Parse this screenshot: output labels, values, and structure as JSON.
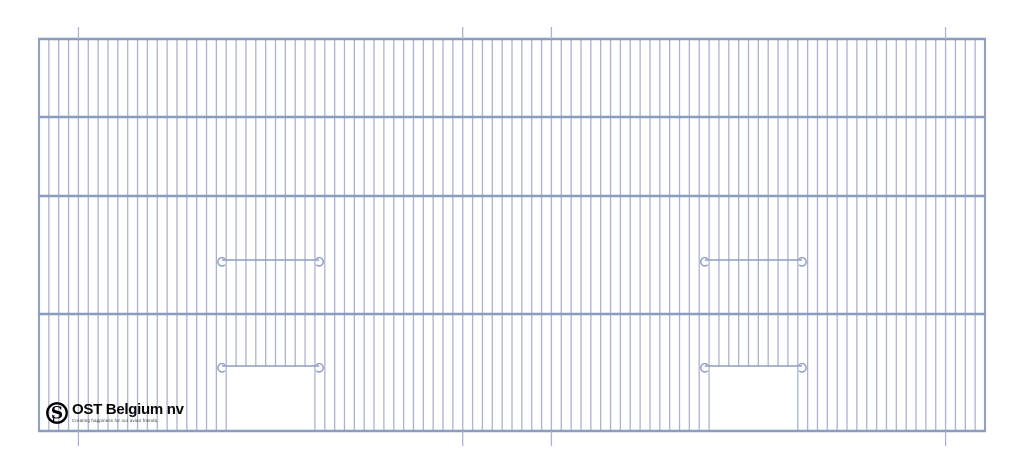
{
  "logo": {
    "name": "OST Belgium nv",
    "tagline": "Creating happiness for our avian friends.",
    "monogram": "S",
    "monogram_small": "J"
  },
  "drawing": {
    "canvas": {
      "width": 1024,
      "height": 473
    },
    "frame": {
      "left": 39,
      "right": 985,
      "top": 39,
      "bottom": 431
    },
    "horizontal_bars_y": [
      39,
      117,
      196,
      314,
      431
    ],
    "wire_count": 97,
    "colors": {
      "wire": "#a9b5ce",
      "wire_edge": "#93a2c2",
      "bar": "#8a9cc0",
      "rail": "#8d9ec2",
      "logo_ink": "#000000"
    },
    "ticks": {
      "wire_indices": [
        4,
        43,
        52,
        92
      ],
      "top_from_y": 27,
      "bottom_to_y": 446
    },
    "doors": [
      {
        "side": "left",
        "start_wire": 19,
        "end_wire": 28,
        "upper_rail_y": 260,
        "lower_rail_y": 366
      },
      {
        "side": "right",
        "start_wire": 68,
        "end_wire": 77,
        "upper_rail_y": 260,
        "lower_rail_y": 366
      }
    ],
    "hook": {
      "radius": 4.2,
      "overhang": 7
    }
  }
}
